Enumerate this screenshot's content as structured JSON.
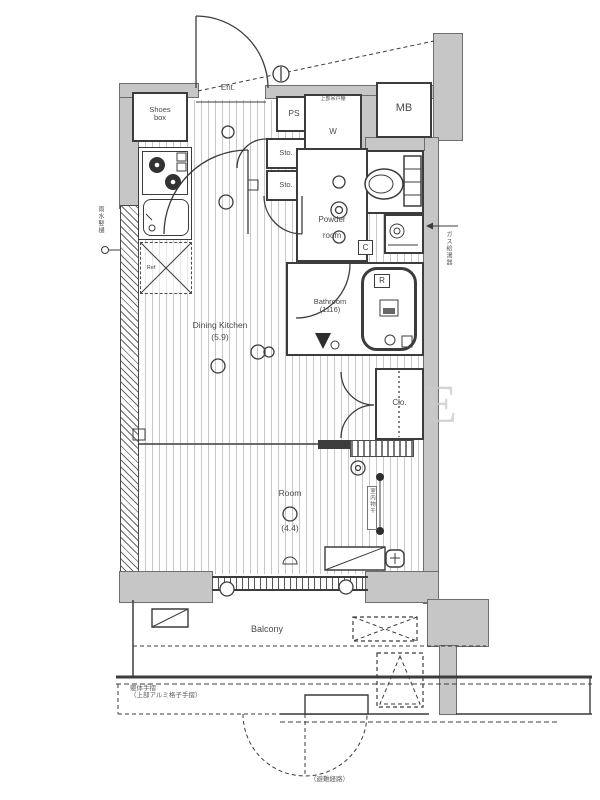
{
  "labels": {
    "entrance": "Ent.",
    "shoes_box_line1": "Shoes",
    "shoes_box_line2": "box",
    "pipe_space": "PS",
    "meter_box": "MB",
    "storage_1": "Sto.",
    "storage_2": "Sto.",
    "washer": "W",
    "washer_shelf_note": "上部吊戸棚",
    "powder_line1": "Powder",
    "powder_line2": "room",
    "bathroom_line1": "Bathroom",
    "bathroom_line2": "(1116)",
    "dk_line1": "Dining Kitchen",
    "dk_line2": "(5.9)",
    "room_line1": "Room",
    "room_line2": "(4.4)",
    "closet": "Clo.",
    "balcony": "Balcony",
    "refrigerator": "Ref",
    "badge_c": "C",
    "badge_r": "R"
  },
  "annotations": {
    "rain_pipe": "雨水竪樋",
    "gas_water_heater": "ガス給湯器",
    "handrail_line1": "躯体手摺",
    "handrail_line2": "（上部アルミ格子手摺）",
    "evacuation_route": "（避難経路）",
    "indoor_laundry": "室内物干",
    "watermark": "E"
  },
  "colors": {
    "wall": "#c6c6c6",
    "line": "#3c3c3c",
    "floor_stripe": "#6e6e6e"
  }
}
